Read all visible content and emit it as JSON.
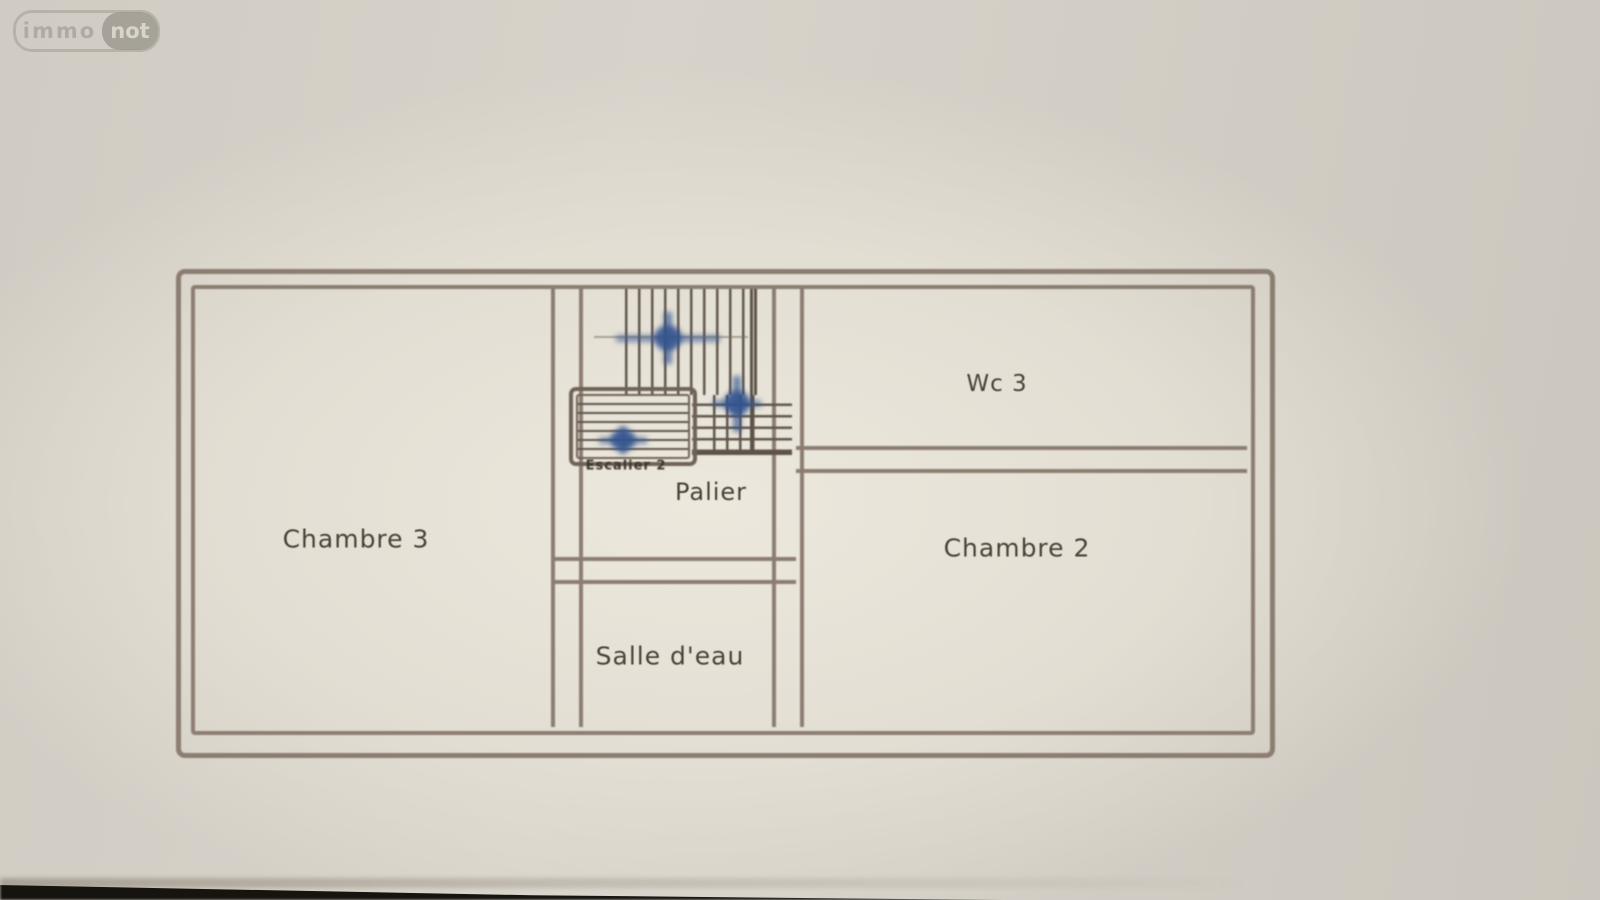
{
  "watermark": {
    "brand_left": "immo",
    "brand_right": "not"
  },
  "floor_plan": {
    "type": "floor-plan",
    "floor": "upper level",
    "rooms": [
      {
        "id": "chambre3",
        "label": "Chambre 3"
      },
      {
        "id": "wc3",
        "label": "Wc 3"
      },
      {
        "id": "chambre2",
        "label": "Chambre 2"
      },
      {
        "id": "palier",
        "label": "Palier"
      },
      {
        "id": "salle_deau",
        "label": "Salle d'eau"
      }
    ],
    "stair_label": "Escalier 2",
    "annotations": "three hand-drawn blue arrows marking stair direction",
    "colors": {
      "paper": "#d4d0c7",
      "plan_paper": "#e9e5da",
      "wall": "#8c7d72",
      "label_text": "#4b4238",
      "stair_arrow_blue": "#2e4f8e",
      "bottom_shadow": "#16140f"
    }
  }
}
